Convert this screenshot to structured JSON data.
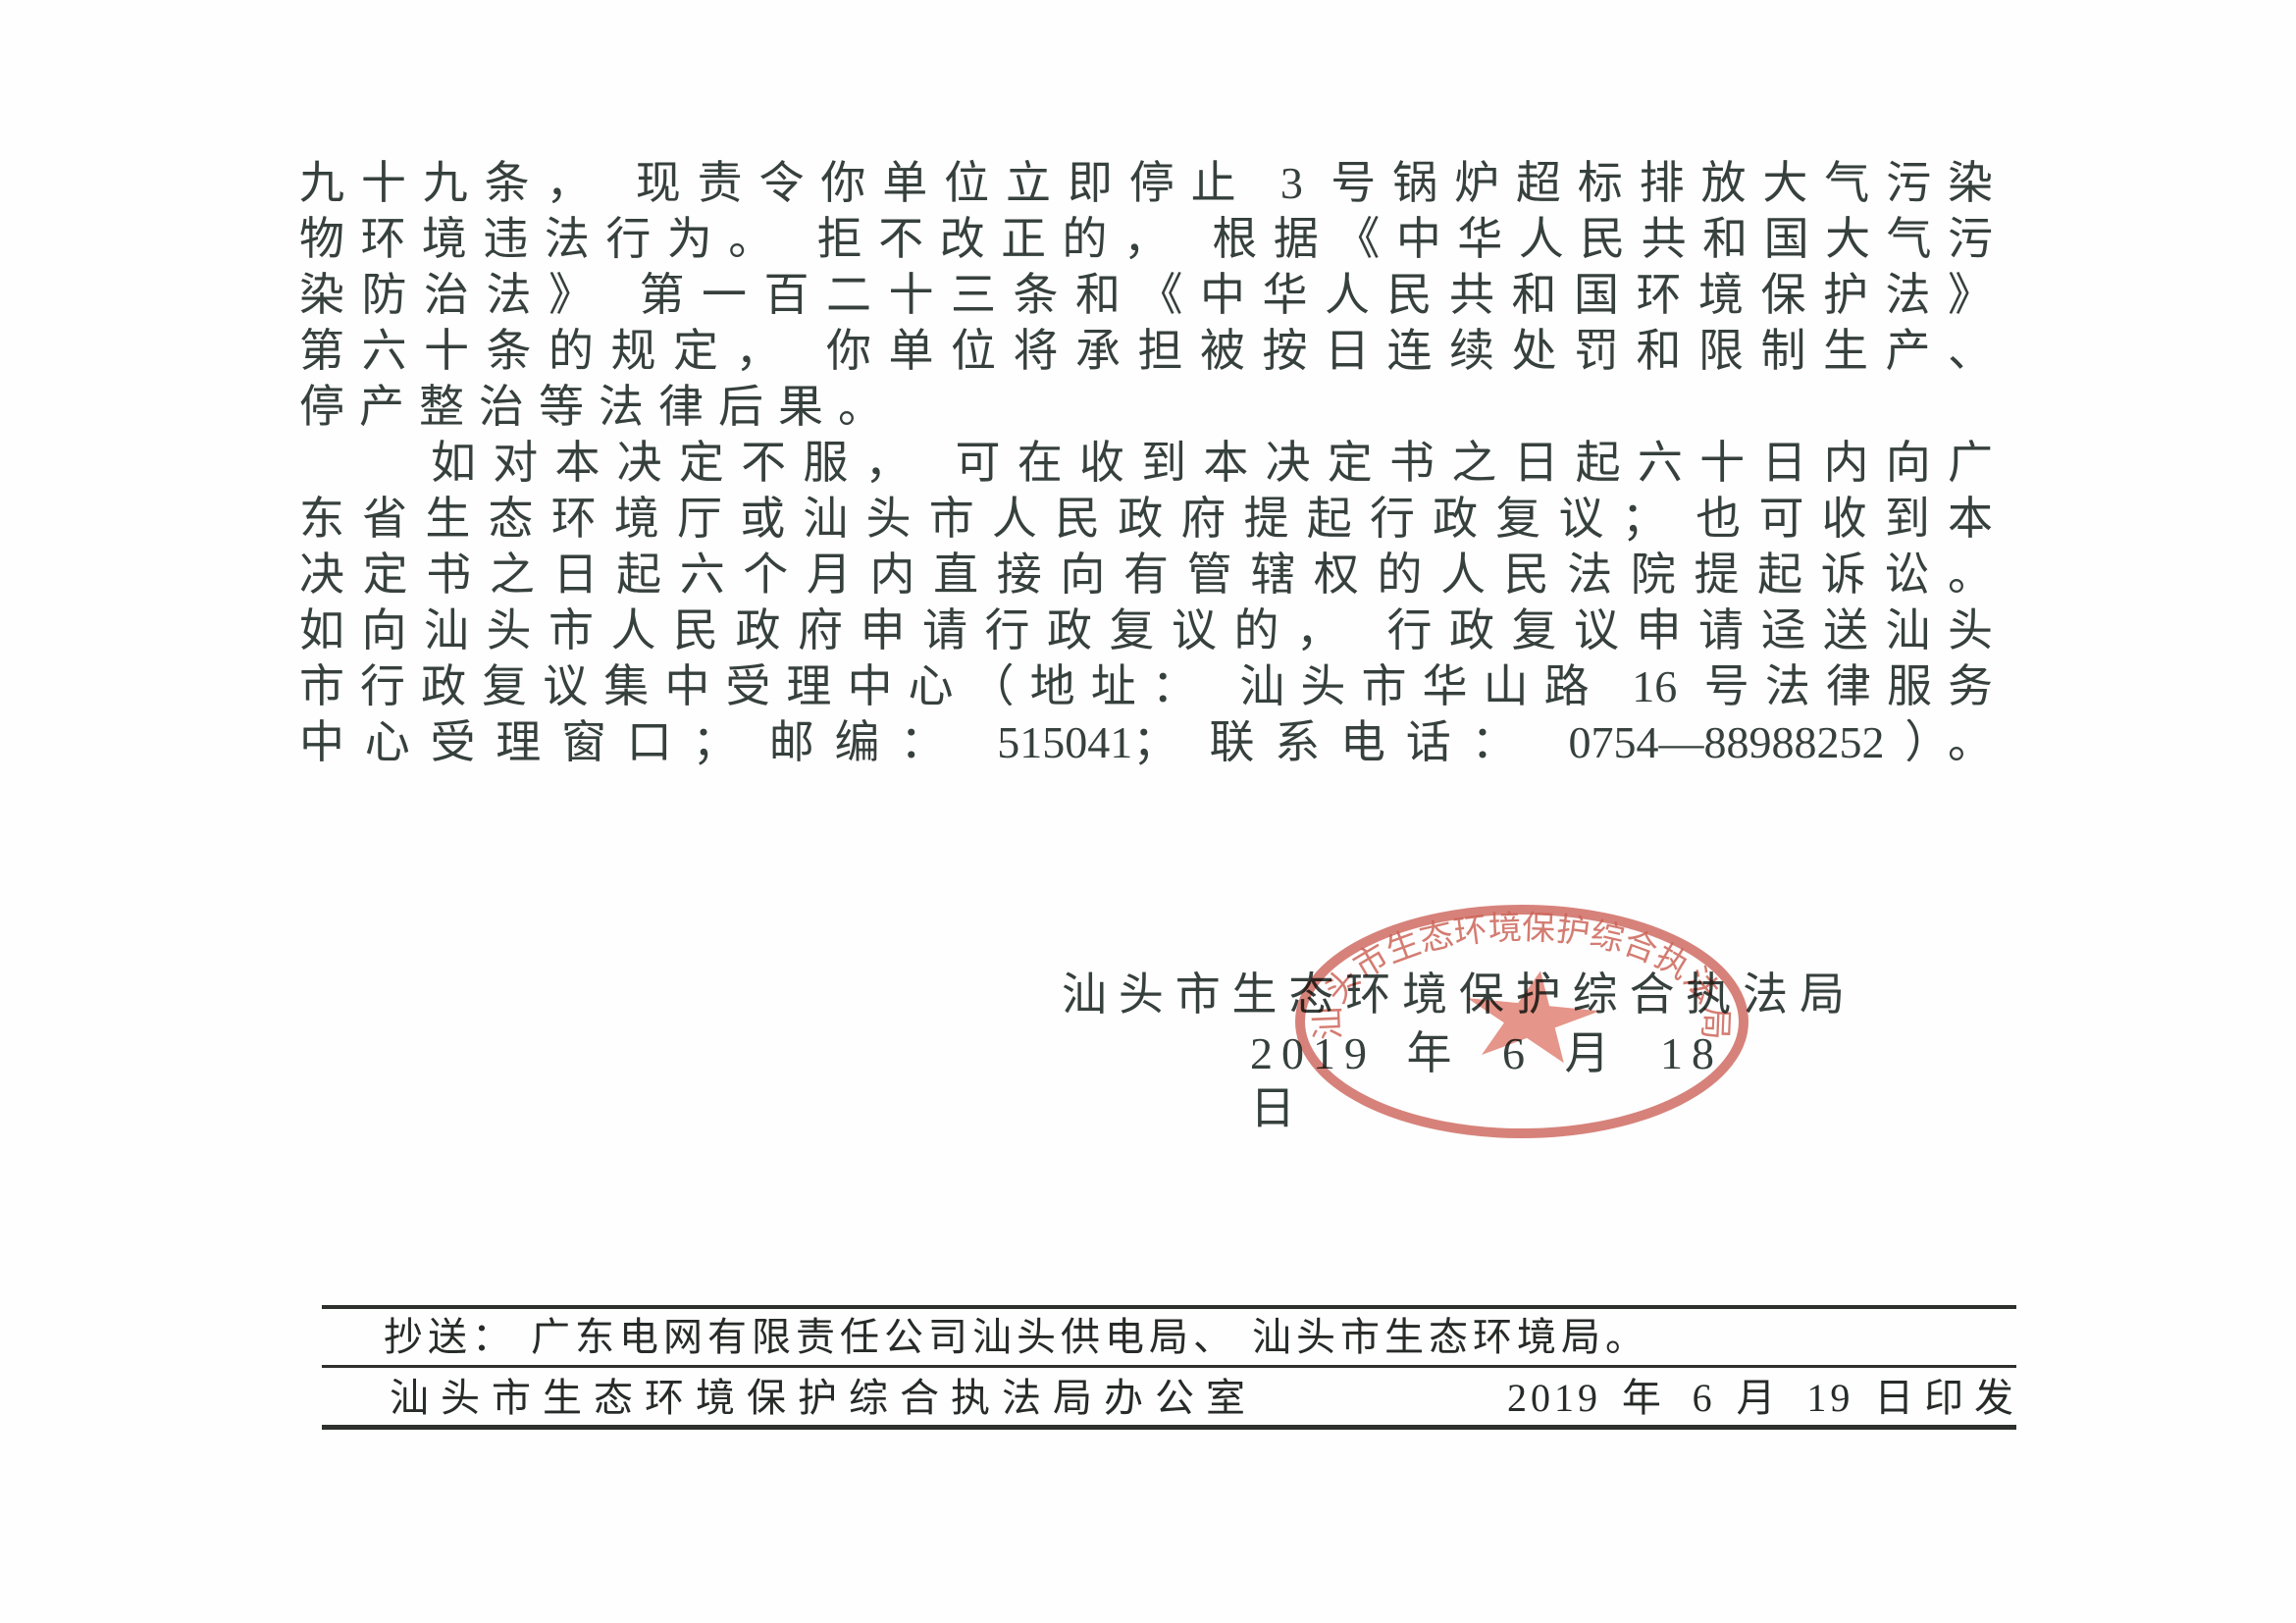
{
  "page": {
    "kind": "scanned official document (continuation page)",
    "background_color": "#fefefe",
    "text_color": "#36403c",
    "seal_color": "#cc6054",
    "seal_star_color": "#e38b7e"
  },
  "body": {
    "lines": [
      {
        "text": "九十九条， 现责令你单位立即停止 3 号锅炉超标排放大气污染",
        "class": "justify"
      },
      {
        "text": "物环境违法行为。 拒不改正的， 根据《中华人民共和国大气污",
        "class": "justify"
      },
      {
        "text": "染防治法》 第一百二十三条和《中华人民共和国环境保护法》",
        "class": "justify"
      },
      {
        "text": "第六十条的规定， 你单位将承担被按日连续处罚和限制生产、",
        "class": "justify"
      },
      {
        "text": "停产整治等法律后果。",
        "class": "short"
      },
      {
        "text": "如对本决定不服， 可在收到本决定书之日起六十日内向广",
        "class": "justify indent"
      },
      {
        "text": "东省生态环境厅或汕头市人民政府提起行政复议； 也可收到本",
        "class": "justify"
      },
      {
        "text": "决定书之日起六个月内直接向有管辖权的人民法院提起诉讼。",
        "class": "justify"
      },
      {
        "text": "如向汕头市人民政府申请行政复议的， 行政复议申请迳送汕头",
        "class": "justify"
      },
      {
        "text": "市行政复议集中受理中心（地址： 汕头市华山路 16 号法律服务",
        "class": "justify"
      },
      {
        "text": "中心受理窗口； 邮编： 515041； 联系电话： 0754—88988252）。",
        "class": "justify"
      }
    ]
  },
  "signature": {
    "agency": "汕头市生态环境保护综合执法局",
    "date": "2019 年 6 月 18 日"
  },
  "seal": {
    "ring_text": "汕头市生态环境保护综合执法局"
  },
  "footer": {
    "cc_line": "抄送： 广东电网有限责任公司汕头供电局、 汕头市生态环境局。",
    "issuer": "汕头市生态环境保护综合执法局办公室",
    "print_date": "2019 年 6 月 19 日印发"
  }
}
